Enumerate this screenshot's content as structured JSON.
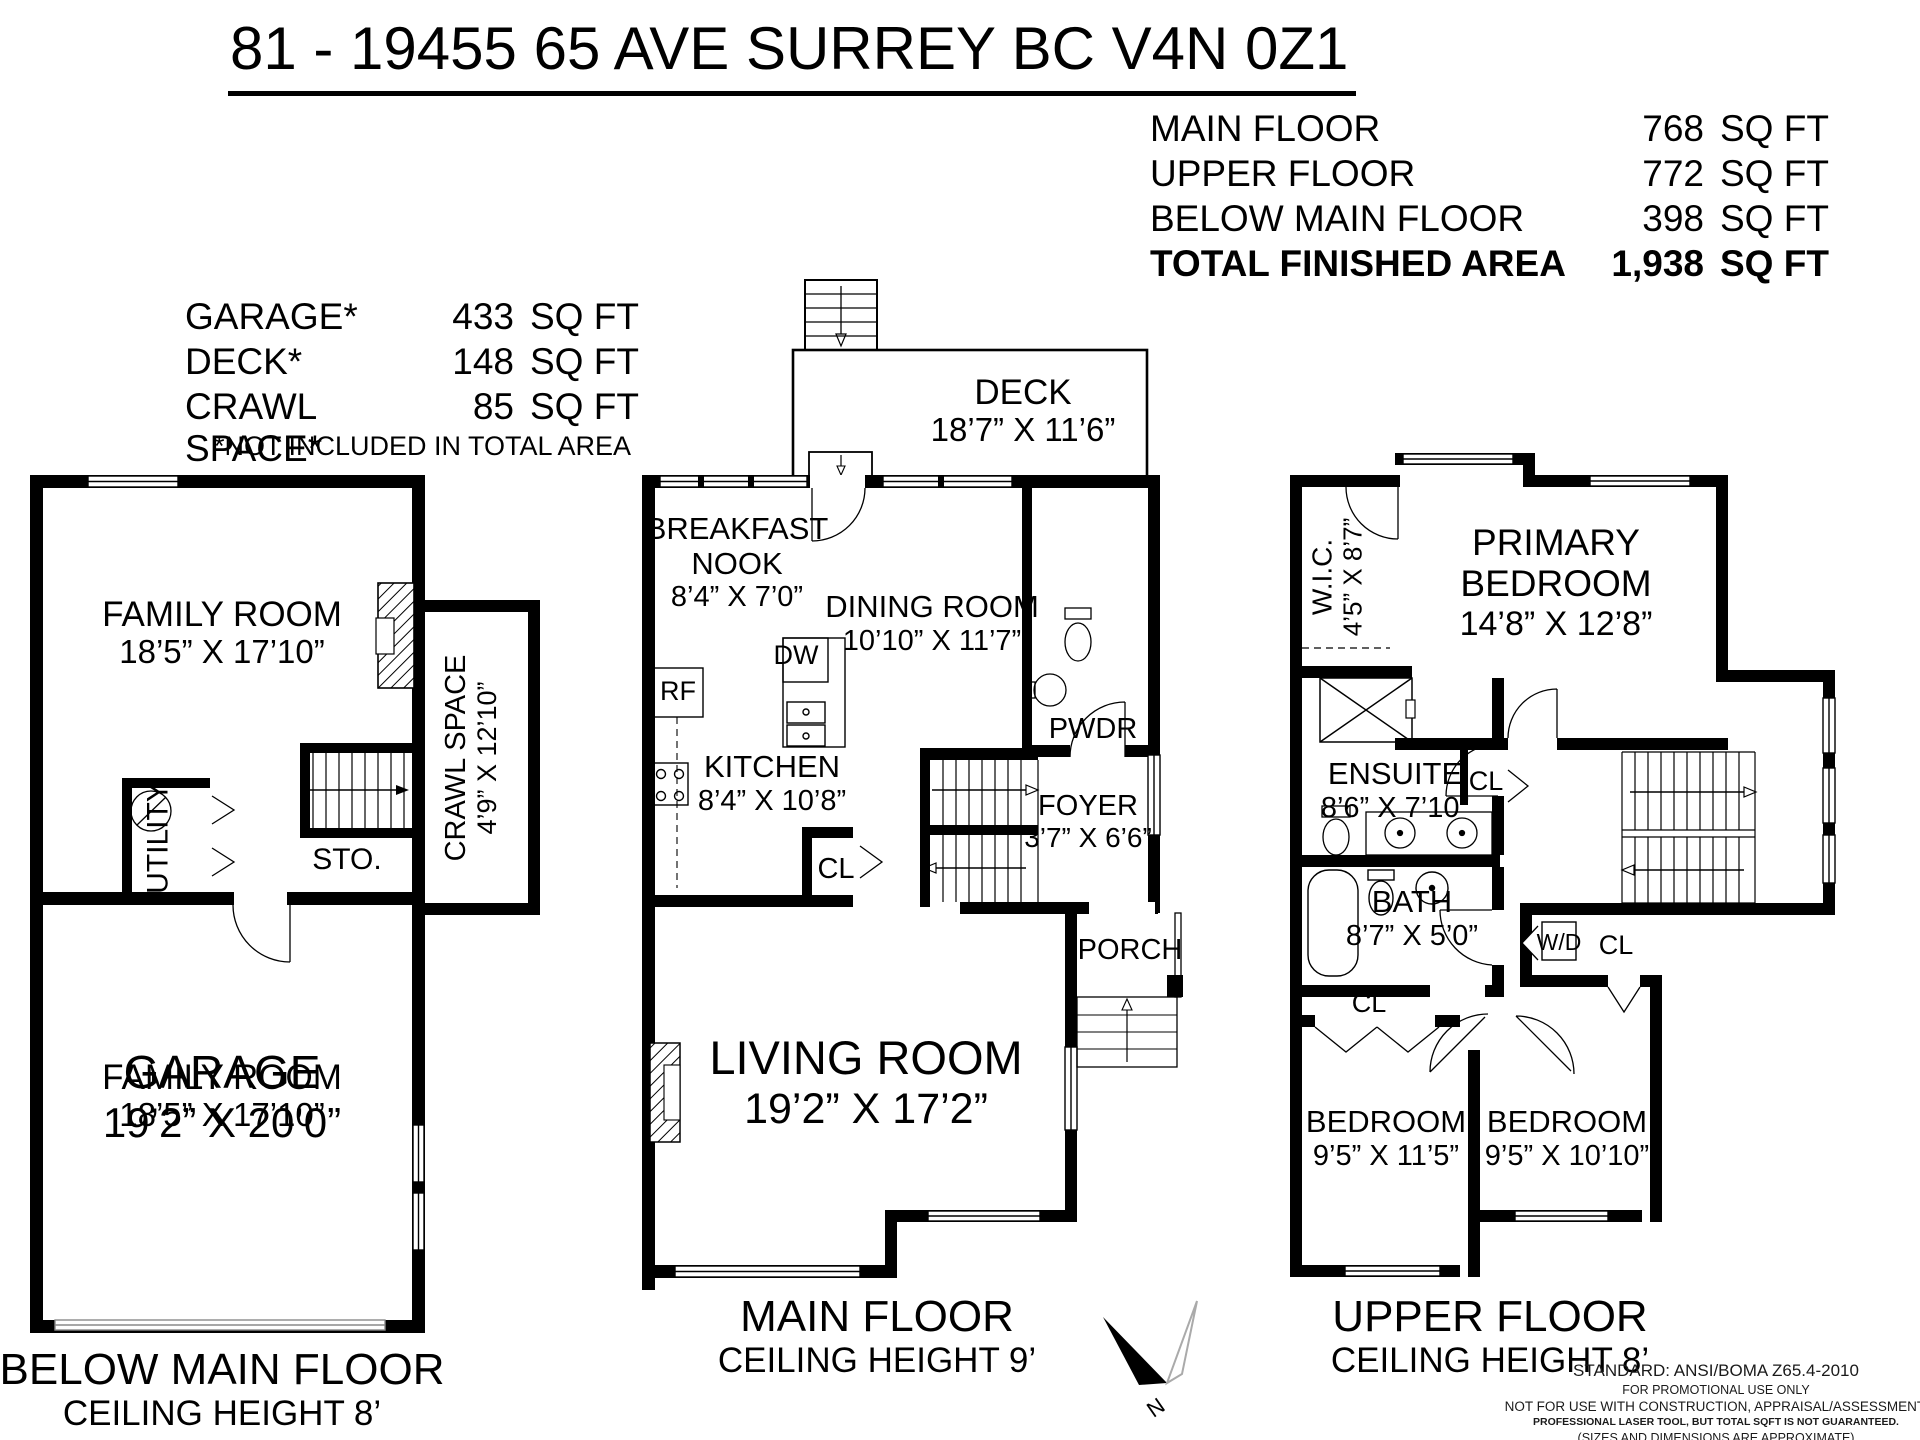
{
  "header": {
    "title": "81 - 19455 65 AVE SURREY BC  V4N 0Z1"
  },
  "area_summary": {
    "rows": [
      {
        "label": "MAIN FLOOR",
        "value": "768",
        "unit": "SQ FT"
      },
      {
        "label": "UPPER FLOOR",
        "value": "772",
        "unit": "SQ FT"
      },
      {
        "label": "BELOW MAIN FLOOR",
        "value": "398",
        "unit": "SQ FT"
      },
      {
        "label": "TOTAL FINISHED AREA",
        "value": "1,938",
        "unit": "SQ FT"
      }
    ]
  },
  "excluded": {
    "rows": [
      {
        "label": "GARAGE*",
        "value": "433",
        "unit": "SQ FT"
      },
      {
        "label": "DECK*",
        "value": "148",
        "unit": "SQ FT"
      },
      {
        "label": "CRAWL SPACE*",
        "value": "85",
        "unit": "SQ FT"
      }
    ],
    "note": "*NOT INCLUDED IN TOTAL AREA"
  },
  "plans": {
    "below_main": {
      "caption": "BELOW MAIN FLOOR",
      "ceiling": "CEILING HEIGHT 8’",
      "family_room": {
        "name": "FAMILY ROOM",
        "dims": "18’5” X 17’10”"
      },
      "garage": {
        "name": "GARAGE",
        "dims": "19’2” X 20’0”"
      },
      "crawl_space": {
        "name": "CRAWL SPACE",
        "dims": "4’9” X 12’10”"
      },
      "utility": {
        "name": "UTILITY"
      },
      "storage": {
        "name": "STO."
      }
    },
    "main": {
      "caption": "MAIN FLOOR",
      "ceiling": "CEILING HEIGHT 9’",
      "deck": {
        "name": "DECK",
        "dims": "18’7” X 11’6”"
      },
      "breakfast_nook": {
        "line1": "BREAKFAST",
        "line2": "NOOK",
        "dims": "8’4” X 7’0”"
      },
      "dining": {
        "name": "DINING ROOM",
        "dims": "10’10” X 11’7”"
      },
      "kitchen": {
        "name": "KITCHEN",
        "dims": "8’4” X 10’8”"
      },
      "living": {
        "name": "LIVING ROOM",
        "dims": "19’2” X 17’2”"
      },
      "foyer": {
        "name": "FOYER",
        "dims": "3’7” X 6’6”"
      },
      "powder": {
        "name": "PWDR"
      },
      "porch": {
        "name": "PORCH"
      },
      "closet": {
        "name": "CL"
      },
      "fridge": {
        "name": "RF"
      },
      "dishwasher": {
        "name": "DW"
      }
    },
    "upper": {
      "caption": "UPPER FLOOR",
      "ceiling": "CEILING HEIGHT 8’",
      "primary": {
        "line1": "PRIMARY",
        "line2": "BEDROOM",
        "dims": "14’8” X 12’8”"
      },
      "wic": {
        "name": "W.I.C.",
        "dims": "4’5” X 8’7”"
      },
      "ensuite": {
        "name": "ENSUITE",
        "dims": "8’6” X 7’10”"
      },
      "bath": {
        "name": "BATH",
        "dims": "8’7” X 5’0”"
      },
      "bedroom_left": {
        "name": "BEDROOM",
        "dims": "9’5” X 11’5”"
      },
      "bedroom_right": {
        "name": "BEDROOM",
        "dims": "9’5” X 10’10”"
      },
      "closet_bath": {
        "name": "CL"
      },
      "closet_primary": {
        "name": "CL"
      },
      "closet_hall": {
        "name": "CL"
      },
      "washer_dryer": {
        "name": "W/D"
      }
    }
  },
  "compass": {
    "label": "N"
  },
  "disclaimer": {
    "l1": "STANDARD: ANSI/BOMA Z65.4-2010",
    "l2": "FOR PROMOTIONAL USE ONLY",
    "l3": "NOT FOR USE WITH CONSTRUCTION, APPRAISAL/ASSESSMENT.",
    "l4": "PROFESSIONAL LASER TOOL, BUT TOTAL SQFT IS NOT GUARANTEED.",
    "l5": "(SIZES AND DIMENSIONS ARE APPROXIMATE)",
    "l6": "powered by shubin.info production. e&o insured"
  }
}
